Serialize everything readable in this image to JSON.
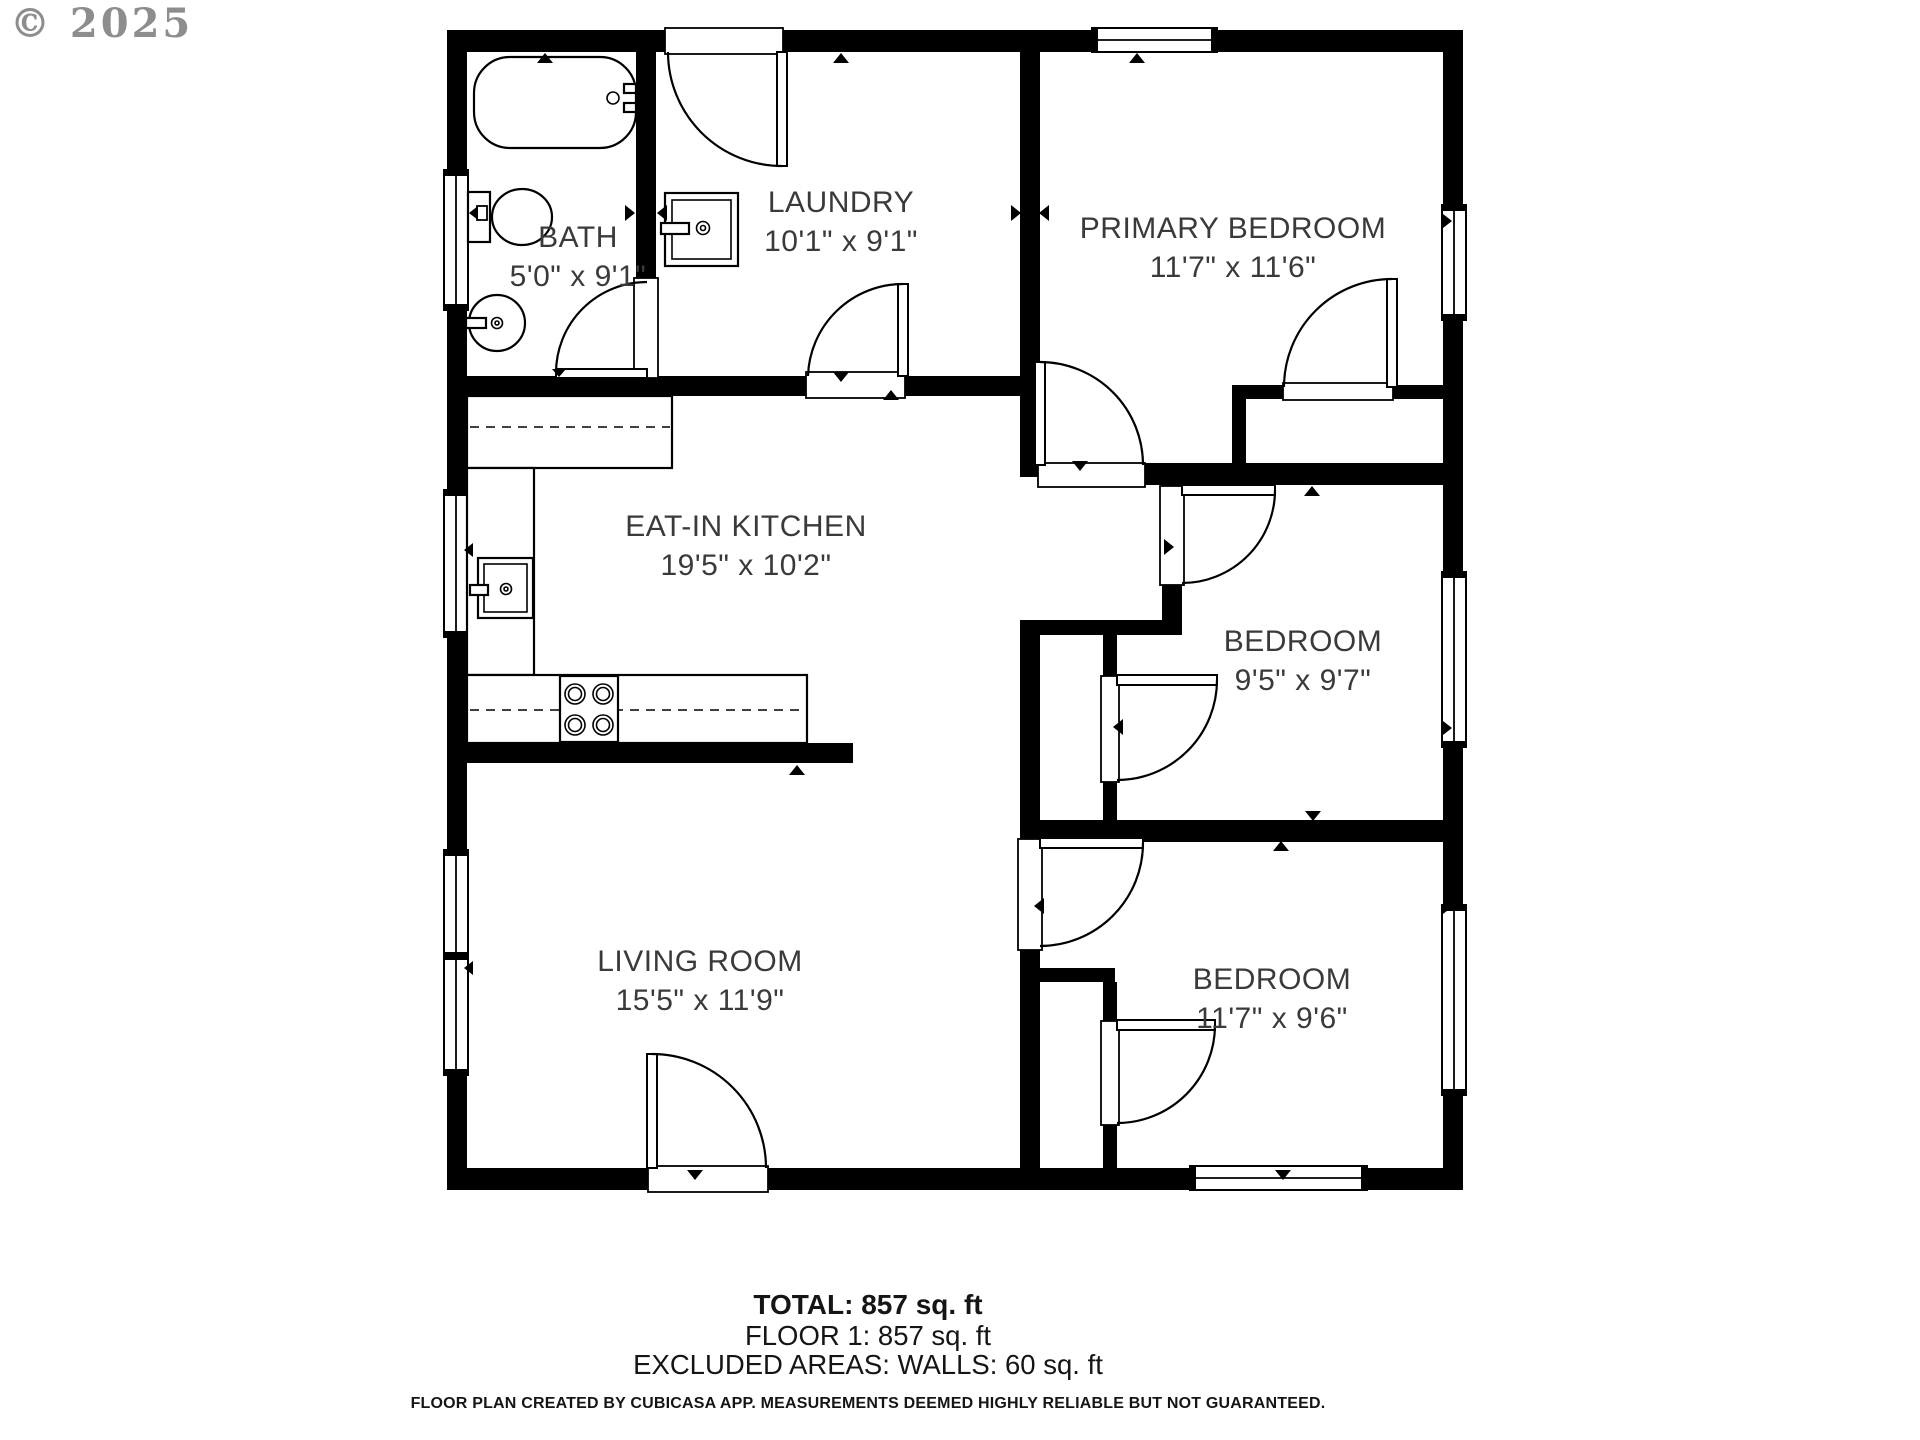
{
  "watermark": {
    "text": "© 2025"
  },
  "rooms": [
    {
      "name": "BATH",
      "dims": "5'0\" x 9'1\""
    },
    {
      "name": "LAUNDRY",
      "dims": "10'1\" x 9'1\""
    },
    {
      "name": "PRIMARY BEDROOM",
      "dims": "11'7\" x 11'6\""
    },
    {
      "name": "EAT-IN KITCHEN",
      "dims": "19'5\" x 10'2\""
    },
    {
      "name": "BEDROOM",
      "dims": "9'5\" x 9'7\""
    },
    {
      "name": "LIVING ROOM",
      "dims": "15'5\" x 11'9\""
    },
    {
      "name": "BEDROOM",
      "dims": "11'7\" x 9'6\""
    }
  ],
  "footer": {
    "total": "TOTAL: 857 sq. ft",
    "floor": "FLOOR 1: 857 sq. ft",
    "excluded": "EXCLUDED AREAS: WALLS: 60 sq. ft",
    "disclaimer": "FLOOR PLAN CREATED BY CUBICASA APP. MEASUREMENTS DEEMED HIGHLY RELIABLE BUT NOT GUARANTEED."
  },
  "icons": [
    "bathtub-icon",
    "toilet-icon",
    "bath-sink-icon",
    "washer-icon",
    "kitchen-sink-icon",
    "stove-icon",
    "window-icon",
    "door-icon",
    "direction-arrow-icon"
  ],
  "colors": {
    "wall": "#000000",
    "label_text": "#3a3a3a",
    "footer_text": "#151515",
    "watermark": "#8d8d8d"
  }
}
